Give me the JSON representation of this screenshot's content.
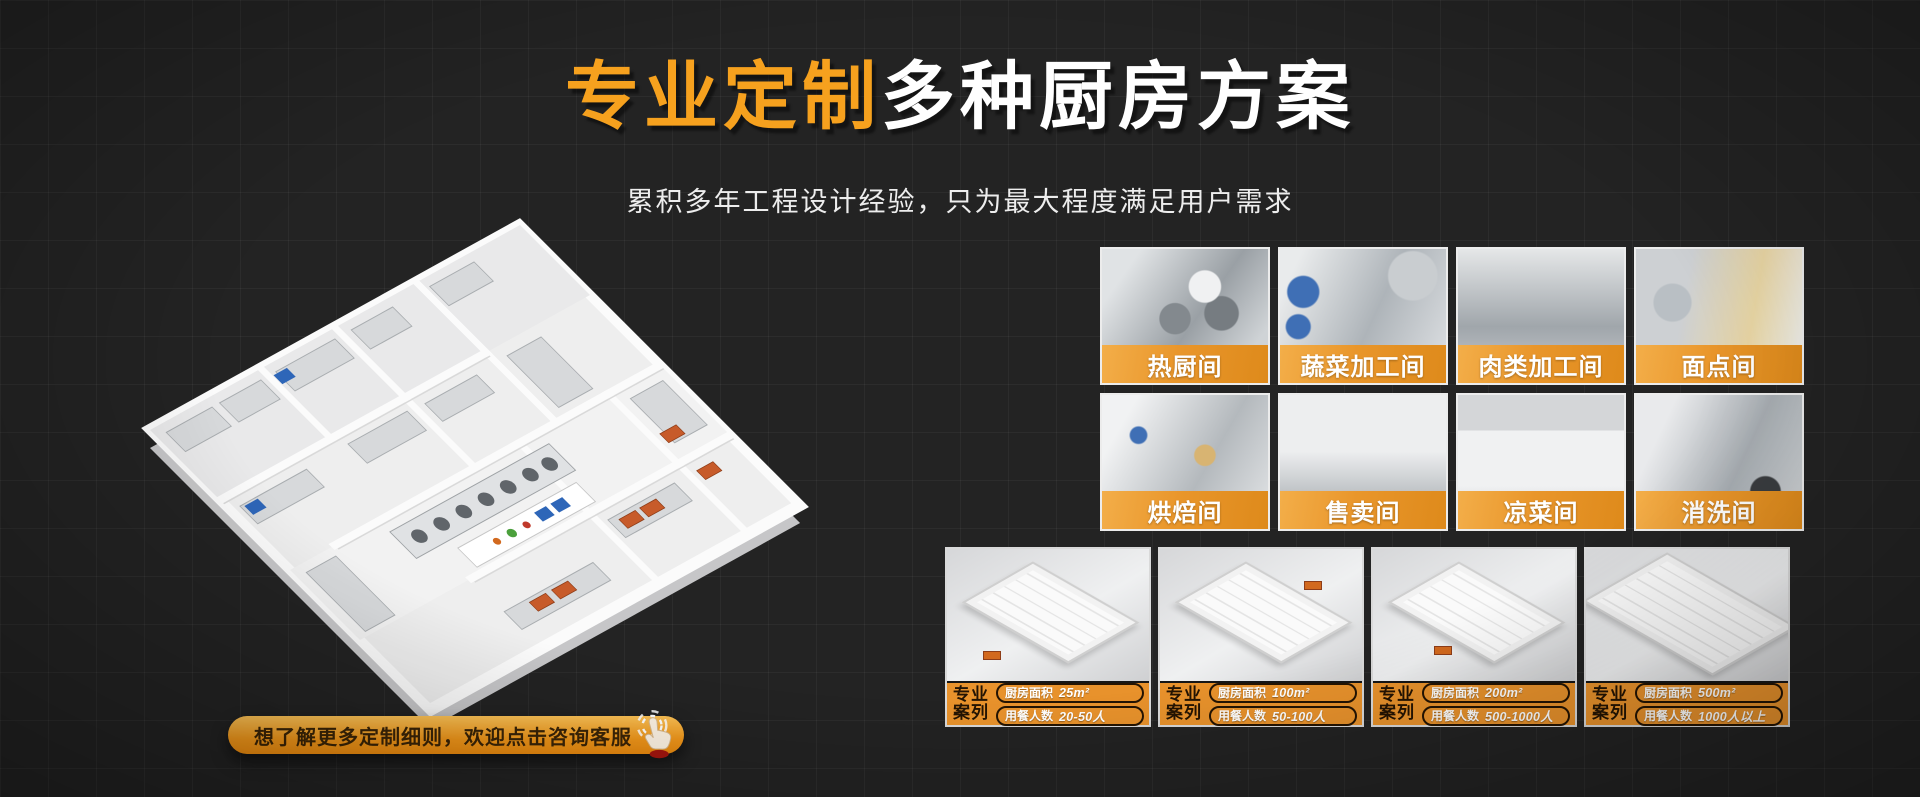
{
  "hero": {
    "title_highlight": "专业定制",
    "title_rest": "多种厨房方案",
    "subtitle": "累积多年工程设计经验，只为最大程度满足用户需求"
  },
  "cta": {
    "label": "想了解更多定制细则，欢迎点击咨询客服"
  },
  "rooms": [
    "热厨间",
    "蔬菜加工间",
    "肉类加工间",
    "面点间",
    "烘焙间",
    "售卖间",
    "凉菜间",
    "消洗间"
  ],
  "case_labels": {
    "badge_line1": "专业",
    "badge_line2": "案列",
    "area": "厨房面积",
    "diners": "用餐人数"
  },
  "cases": [
    {
      "area": "25m²",
      "diners": "20-50人"
    },
    {
      "area": "100m²",
      "diners": "50-100人"
    },
    {
      "area": "200m²",
      "diners": "500-1000人"
    },
    {
      "area": "500m²",
      "diners": "1000人以上"
    }
  ],
  "icons": {
    "cta_icon": "click-hand-icon"
  },
  "colors": {
    "accent_orange": "#F6A11E",
    "banner_orange": "#E8922C",
    "background": "#232323"
  }
}
